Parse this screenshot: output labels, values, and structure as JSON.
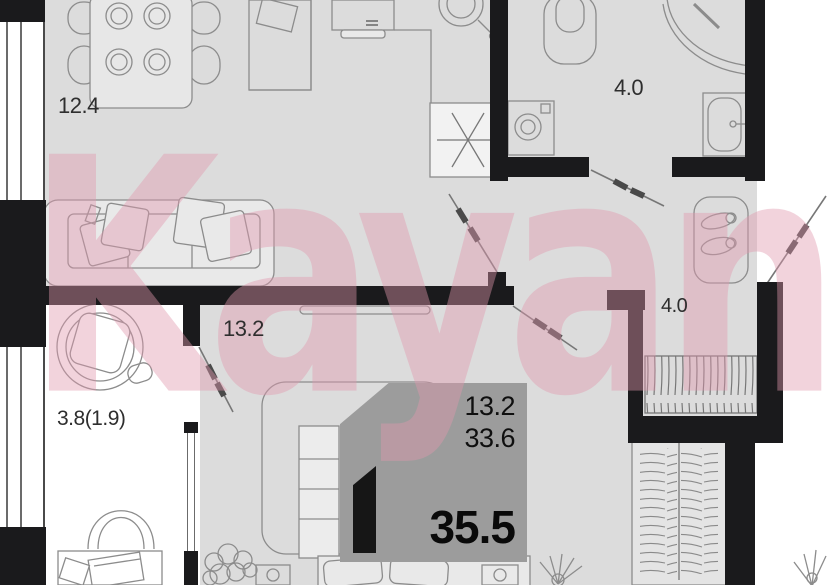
{
  "watermark": {
    "text": "Kayan"
  },
  "rooms": {
    "kitchen_living": {
      "area": "12.4"
    },
    "bathroom": {
      "area": "4.0"
    },
    "hallway": {
      "area": "4.0"
    },
    "bedroom": {
      "area": "13.2"
    },
    "balcony": {
      "area": "3.8(1.9)"
    }
  },
  "info_box": {
    "living_area": "13.2",
    "area_without_balcony": "33.6",
    "total_area": "35.5"
  },
  "colors": {
    "wall": "#1a1a1c",
    "floor": "#dcdcdc",
    "balcony_floor": "#ffffff",
    "info_box_bg": "#9c9c9c",
    "watermark_pink": "#e298ae"
  }
}
